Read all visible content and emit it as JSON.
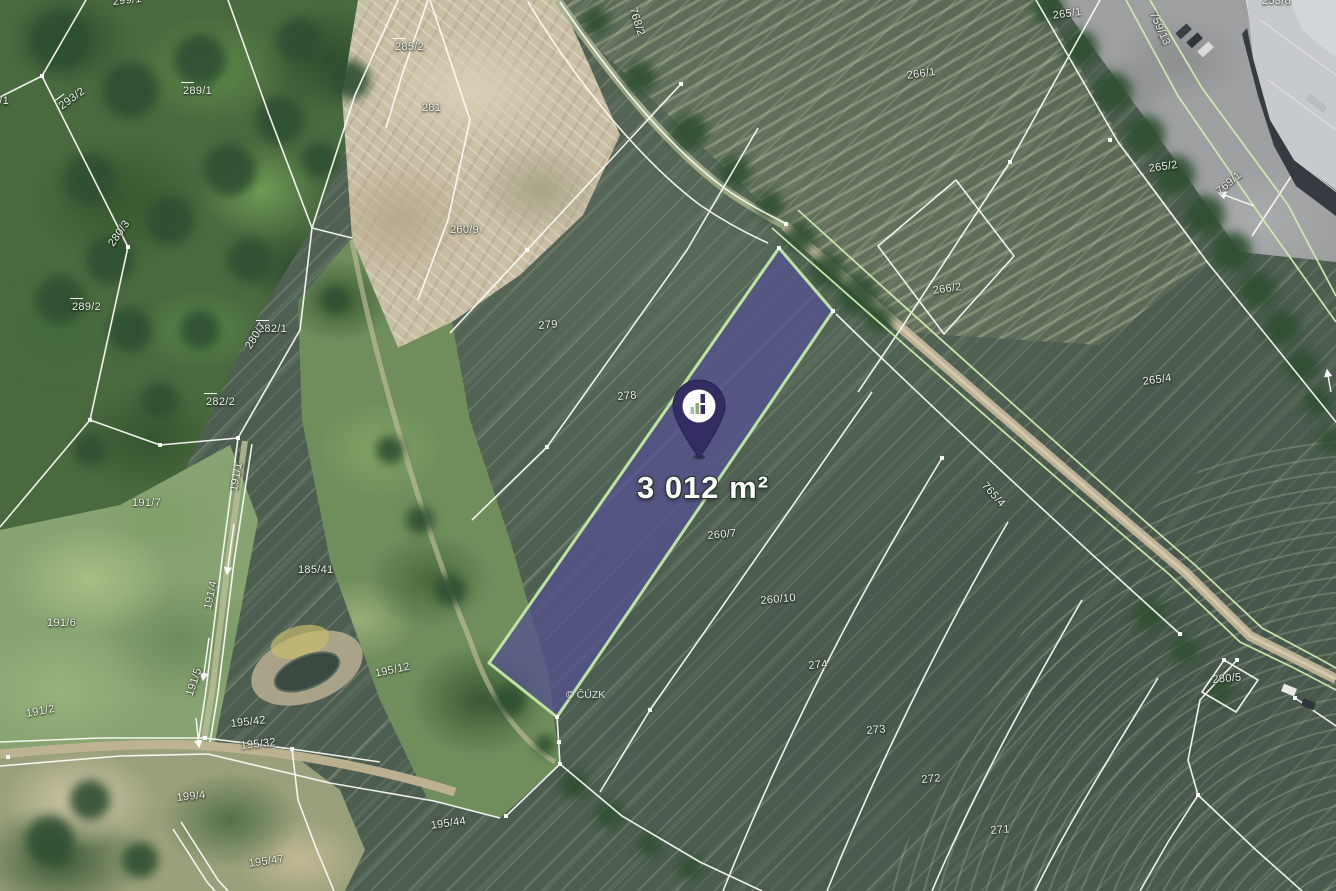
{
  "map": {
    "type": "cadastral-satellite-map",
    "area_label": "3 012 m²",
    "watermark": "© ČÚZK",
    "pin": {
      "icon": "bar-chart-logo-icon",
      "color": "#332d63"
    },
    "highlight": {
      "fill": "#554f92",
      "border": "#bce3a2",
      "area": "3 012 m²"
    },
    "colors": {
      "boundary_white": "#fdfdf8",
      "boundary_green": "#cfeab0",
      "field_green": "#4d5d50",
      "sand": "#c9bfa5"
    },
    "parcel_labels": [
      {
        "t": "299/1",
        "x": 112,
        "y": -4,
        "r": -6
      },
      {
        "t": "293/1",
        "x": -20,
        "y": 95,
        "r": 0
      },
      {
        "t": "293/2",
        "x": 55,
        "y": 100,
        "r": -36,
        "dash": true
      },
      {
        "t": "289/1",
        "x": 183,
        "y": 82,
        "r": 0,
        "dash": true
      },
      {
        "t": "285/2",
        "x": 395,
        "y": 38,
        "r": 0,
        "dash": true
      },
      {
        "t": "281",
        "x": 422,
        "y": 102,
        "r": 0
      },
      {
        "t": "260/9",
        "x": 450,
        "y": 224,
        "r": 0
      },
      {
        "t": "768/2",
        "x": 638,
        "y": 6,
        "r": 72
      },
      {
        "t": "266/1",
        "x": 906,
        "y": 70,
        "r": -8
      },
      {
        "t": "265/1",
        "x": 1052,
        "y": 10,
        "r": -8
      },
      {
        "t": "759/13",
        "x": 1158,
        "y": 10,
        "r": 66
      },
      {
        "t": "266/2",
        "x": 932,
        "y": 285,
        "r": -8
      },
      {
        "t": "265/2",
        "x": 1148,
        "y": 163,
        "r": -8
      },
      {
        "t": "769/1",
        "x": 1214,
        "y": 188,
        "r": -40
      },
      {
        "t": "265/4",
        "x": 1142,
        "y": 376,
        "r": -8
      },
      {
        "t": "765/4",
        "x": 988,
        "y": 480,
        "r": 48
      },
      {
        "t": "280/3",
        "x": 106,
        "y": 242,
        "r": -55
      },
      {
        "t": "289/2",
        "x": 72,
        "y": 298,
        "r": 0,
        "dash": true
      },
      {
        "t": "282/1",
        "x": 258,
        "y": 320,
        "r": 0,
        "dash": true
      },
      {
        "t": "280/7",
        "x": 243,
        "y": 345,
        "r": -58
      },
      {
        "t": "282/2",
        "x": 206,
        "y": 393,
        "r": 0,
        "dash": true
      },
      {
        "t": "191/7",
        "x": 132,
        "y": 497,
        "r": 0
      },
      {
        "t": "191/1",
        "x": 228,
        "y": 490,
        "r": -80
      },
      {
        "t": "185/41",
        "x": 298,
        "y": 564,
        "r": 0
      },
      {
        "t": "191/4",
        "x": 202,
        "y": 608,
        "r": -78
      },
      {
        "t": "191/6",
        "x": 47,
        "y": 617,
        "r": 0
      },
      {
        "t": "191/2",
        "x": 25,
        "y": 708,
        "r": -10
      },
      {
        "t": "191/5",
        "x": 184,
        "y": 694,
        "r": -72
      },
      {
        "t": "195/42",
        "x": 230,
        "y": 718,
        "r": -6
      },
      {
        "t": "195/32",
        "x": 240,
        "y": 740,
        "r": -6
      },
      {
        "t": "199/4",
        "x": 176,
        "y": 792,
        "r": -6
      },
      {
        "t": "195/47",
        "x": 248,
        "y": 858,
        "r": -8
      },
      {
        "t": "195/12",
        "x": 374,
        "y": 668,
        "r": -12
      },
      {
        "t": "195/44",
        "x": 430,
        "y": 820,
        "r": -8
      },
      {
        "t": "279",
        "x": 538,
        "y": 320,
        "r": -5
      },
      {
        "t": "278",
        "x": 617,
        "y": 391,
        "r": -5
      },
      {
        "t": "260/7",
        "x": 707,
        "y": 530,
        "r": -5
      },
      {
        "t": "260/10",
        "x": 760,
        "y": 595,
        "r": -5
      },
      {
        "t": "274",
        "x": 808,
        "y": 660,
        "r": -5
      },
      {
        "t": "273",
        "x": 866,
        "y": 725,
        "r": -5
      },
      {
        "t": "272",
        "x": 921,
        "y": 774,
        "r": -5
      },
      {
        "t": "271",
        "x": 990,
        "y": 825,
        "r": -5
      },
      {
        "t": "280/5",
        "x": 1212,
        "y": 674,
        "r": -5
      },
      {
        "t": "253/8",
        "x": 1262,
        "y": -5,
        "r": 0
      }
    ]
  }
}
